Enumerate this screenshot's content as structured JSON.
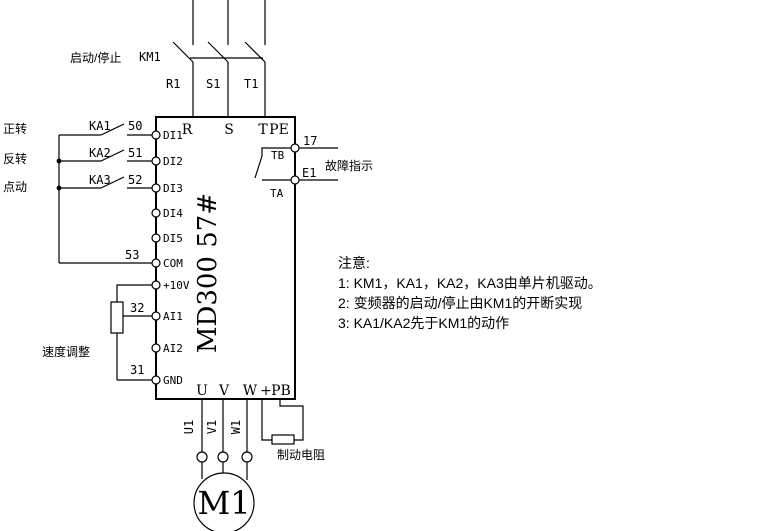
{
  "colors": {
    "line": "#000000",
    "background": "#ffffff"
  },
  "power_input": {
    "start_stop_label": "启动/停止",
    "contactor_label": "KM1",
    "phase_wires": [
      "R1",
      "S1",
      "T1"
    ]
  },
  "inverter": {
    "model": "MD300  57#",
    "top_terminals": [
      "R",
      "S",
      "T",
      "PE"
    ],
    "left_terminals": [
      "DI1",
      "DI2",
      "DI3",
      "DI4",
      "DI5",
      "COM",
      "+10V",
      "AI1",
      "AI2",
      "GND"
    ],
    "bottom_terminals": [
      "U",
      "V",
      "W",
      "+",
      "PB"
    ],
    "fault_contact_labels": [
      "TB",
      "TA"
    ]
  },
  "control_inputs": {
    "function_labels": [
      "正转",
      "反转",
      "点动"
    ],
    "relay_labels": [
      "KA1",
      "KA2",
      "KA3"
    ],
    "wire_numbers": [
      "50",
      "51",
      "52"
    ],
    "common_wire_number": "53"
  },
  "analog_input": {
    "label": "速度调整",
    "wiper_wire_number": "32",
    "gnd_wire_number": "31"
  },
  "fault_output": {
    "wire_numbers": [
      "17",
      "E1"
    ],
    "label": "故障指示"
  },
  "motor_output": {
    "wire_labels": [
      "U1",
      "V1",
      "W1"
    ],
    "motor_label": "M1",
    "brake_resistor_label": "制动电阻"
  },
  "notes": {
    "title": "注意:",
    "items": [
      "1:  KM1，KA1，KA2，KA3由单片机驱动。",
      "2:  变频器的启动/停止由KM1的开断实现",
      "3:  KA1/KA2先于KM1的动作"
    ]
  }
}
